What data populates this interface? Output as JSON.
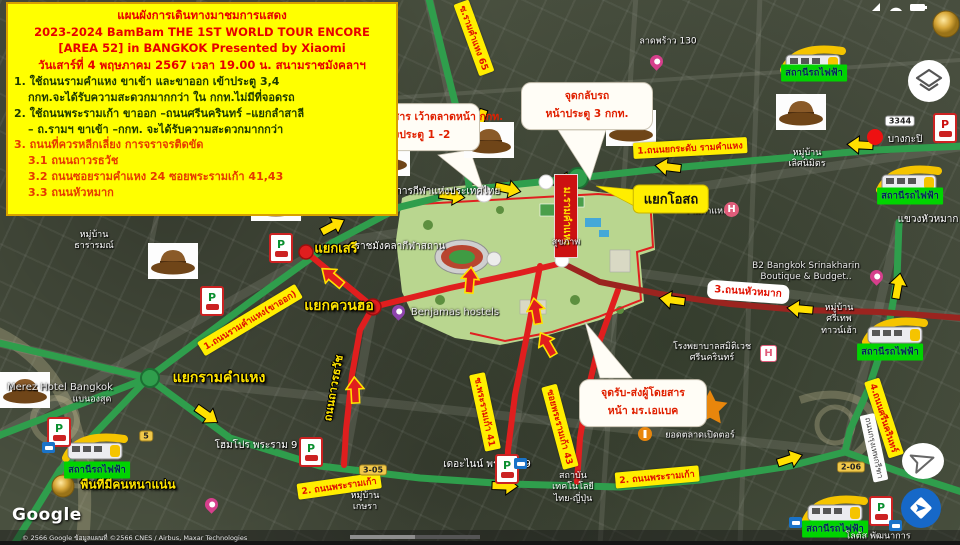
{
  "window": {
    "width": 960,
    "height": 545
  },
  "colors": {
    "route_green": "#2f9e4c",
    "route_red": "#e01e1e",
    "route_dark_red": "#9b241f",
    "label_yellow": "#ffee00",
    "label_red_text": "#e01000",
    "station_green": "#00d400",
    "info_box_yellow": "#ffff00"
  },
  "info_box": {
    "title": "แผนผังการเดินทางมาชมการแสดง",
    "subtitle1": "2023-2024 BamBam THE 1ST WORLD TOUR ENCORE",
    "subtitle2": "[AREA 52] in BANGKOK Presented by Xiaomi",
    "subtitle3": "วันเสาร์ที่ 4 พฤษภาคม 2567 เวลา 19.00 น. สนามราชมังคลาฯ",
    "item1a": "1. ใช้ถนนรามคำแหง ขาเข้า และขาออก เข้าประตู 3,4",
    "item1b": "กกท.จะได้รับความสะดวกมากกว่า ใน กกท.ไม่มีที่จอดรถ",
    "item2a": "2. ใช้ถนนพระรามเก้า ขาออก –ถนนศรีนครินทร์ –แยกลำสาลี",
    "item2b": "– ถ.รามฯ ขาเข้า –กกท. จะได้รับความสะดวกมากกว่า",
    "item3": "3. ถนนที่ควรหลีกเลี่ยง การจราจรติดขัด",
    "item3_1": "3.1 ถนนถาวรธวัช",
    "item3_2": "3.2 ถนนซอยรามคำแหง 24 ซอยพระรามเก้า 41,43",
    "item3_3": "3.3 ถนนหัวหมาก"
  },
  "callouts": {
    "pickup_sat": {
      "line1": "จุดรับ-ส่งผู้โดยสาร เว้าตลาดหน้า กกท.",
      "line2": "อยู่ระหว่างประตู 1 -2"
    },
    "uturn": {
      "line1": "จุดกลับรถ",
      "line2": "หน้าประตู 3 กกท."
    },
    "pickup_abac": {
      "line1": "จุดรับ-ส่งผู้โดยสาร",
      "line2": "หน้า มร.เอแบค"
    }
  },
  "junctions": {
    "osot": "แยกโอสถ",
    "seri": "แยกเสรี",
    "kwanho": "แยกควนฮอ",
    "ramkhamhaeng": "แยกรามคำแหง"
  },
  "notices": {
    "crowded": "พื้นที่มีคนหนาแน่น"
  },
  "route_labels": {
    "soi39": "ซ.รามคำแหง 39",
    "soi65": "ซ.รามคำแหง 65",
    "elevated": "1.ถนนยกระดับ รามคำแหง",
    "ram_outbound": "1.ถนนรามคำแหง(ขาออก)",
    "rama9": "2. ถนนพระรามเก้า",
    "soi41": "ซ.พระรามเก้า 41",
    "soi43": "ซอยพระรามเก้า 43",
    "srinakarin": "4.ถนนศรีนครินทร์",
    "thaworn": "ถนนถาวรธวัช",
    "huamak": "3.ถนนหัวหมาก",
    "kreetha": "ถนนกรุงเทพกรีฑา",
    "uni_banner": "ม.รามคำแหง"
  },
  "stations": {
    "label": "สถานีรถไฟฟ้า"
  },
  "shields": {
    "r3344": "3344",
    "r5": "5",
    "r206": "2-06",
    "r305": "3-05"
  },
  "map_labels": {
    "sat_authority": "การกีฬาแห่งประเทศไทย",
    "rajamangala": "ราชมังคลากีฬาสถาน",
    "sukhapab": "สุขภาพ",
    "kwaeng_huamak": "แขวงหัวหมาก",
    "bangkapi": "บางกะปิ",
    "ladprao130": "ลาดพร้าว 130",
    "tharar_1": "หมู่บ้าน",
    "tharar_2": "ธารารมณ์",
    "lertnimit_1": "หมู่บ้าน",
    "lertnimit_2": "เลิศนิมิตร",
    "b2_1": "B2 Bangkok Srinakharin",
    "b2_2": "Boutique & Budget..",
    "srithep_1": "หมู่บ้าน",
    "srithep_2": "ศรีเทพ",
    "srithep_3": "ทาวน์เฮ้า",
    "samitivej_1": "โรงพยาบาลสมิติเวช",
    "samitivej_2": "ศรีนครินทร์",
    "ram_hospital": "รามคำแหง",
    "benjamas": "Benjamas hostels",
    "merez": "Merez Hotel Bangkok",
    "merez_sub": "แบนองสุด",
    "homepro": "โฮมโปร พระราม 9",
    "the_nine": "เดอะไนน์ พระราม 9",
    "kesara_1": "หมู่บ้าน",
    "kesara_2": "เกษรา",
    "tni_1": "สถาบัน",
    "tni_2": "เทคโนโลยี",
    "tni_3": "ไทย-ญี่ปุ่น",
    "market": "ยอดตลาดเปิดตอร์",
    "lotus": "โลตัส พัฒนาการ"
  },
  "icons": {
    "parking_letter": "P",
    "hospital_letter": "H"
  },
  "attribution": {
    "logo": "Google",
    "text": "© 2566 Google ข้อมูลแผนที่ ©2566 CNES / Airbus, Maxar Technologies"
  }
}
